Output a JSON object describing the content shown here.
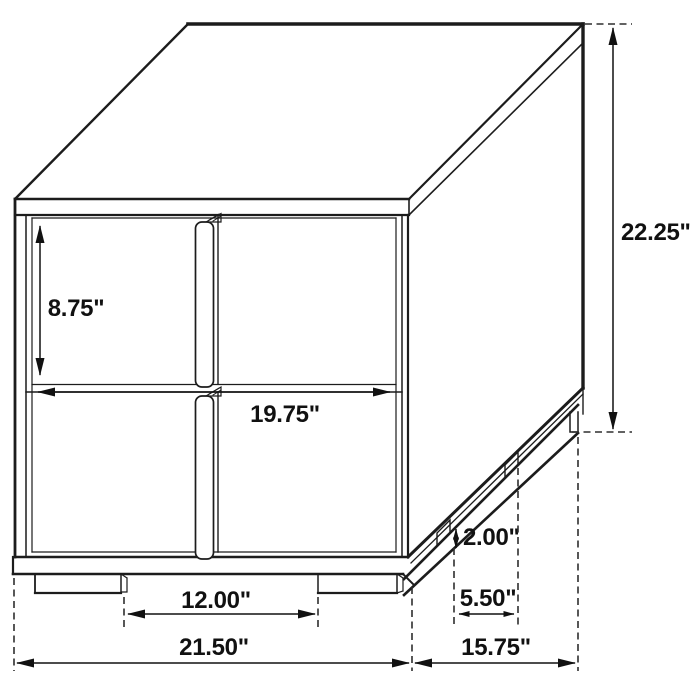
{
  "diagram": {
    "background": "#ffffff",
    "line_color": "#1c1c1c",
    "dimensions": {
      "drawer_height": "8.75\"",
      "drawer_width": "19.75\"",
      "overall_height": "22.25\"",
      "base_height": "2.00\"",
      "side_leg_spacing": "5.50\"",
      "front_leg_spacing": "12.00\"",
      "overall_width": "21.50\"",
      "overall_depth": "15.75\""
    }
  }
}
